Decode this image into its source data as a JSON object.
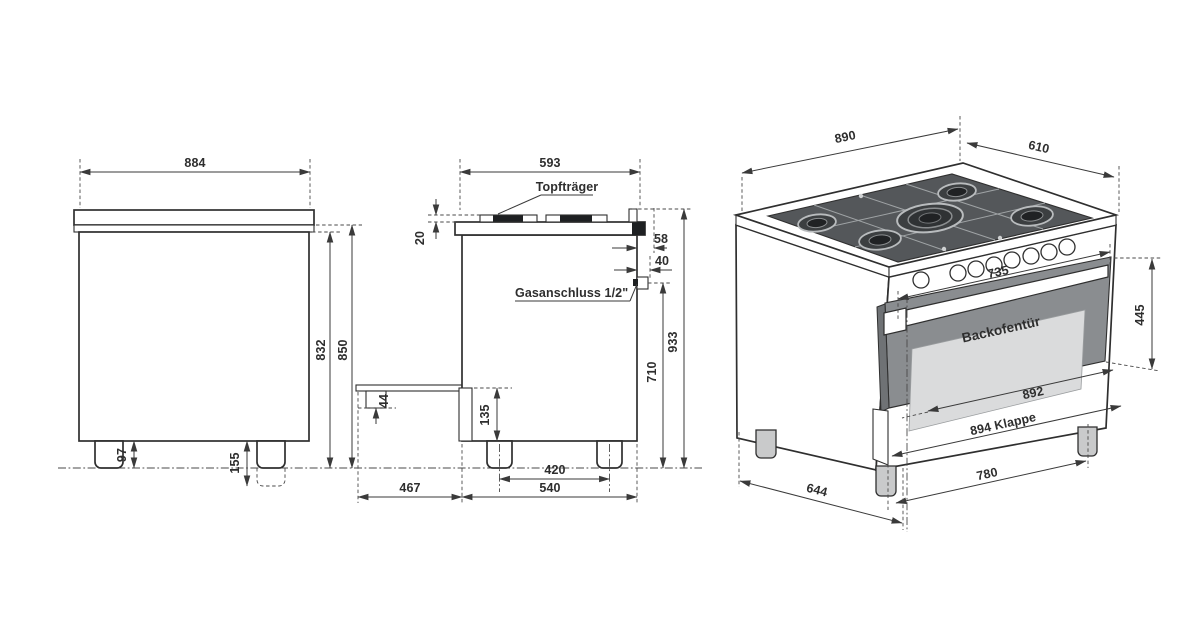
{
  "front_view": {
    "width_mm": "884",
    "height_to_cooktop": "850",
    "height_to_body_top": "832",
    "leg_height": "97",
    "leg_height_adjustable": "155"
  },
  "side_view": {
    "depth_top": "593",
    "pot_support_label": "Topfträger",
    "pot_support_height": "20",
    "rear_edge_offset": "58",
    "gas_connection_offset": "40",
    "gas_connection_label": "Gasanschluss 1/2\"",
    "height_overall": "933",
    "gas_connection_height": "710",
    "front_panel_height": "135",
    "handle_depth": "44",
    "leg_spacing": "420",
    "base_depth": "540",
    "open_door_depth": "467"
  },
  "perspective_view": {
    "width": "890",
    "depth": "610",
    "control_panel_width": "735",
    "oven_door_label": "Backofentür",
    "oven_door_height": "445",
    "oven_door_width": "892",
    "flap_width_label": "894 Klappe",
    "front_leg_spacing": "780",
    "side_leg_spacing": "644"
  },
  "colors": {
    "line": "#3a3a3a",
    "text": "#2e2e2e",
    "door_frame": "#8a8d90",
    "door_glass": "#dadbdc",
    "hob_dark": "#54575a",
    "leg_gray": "#c9cacb",
    "background": "#ffffff"
  }
}
